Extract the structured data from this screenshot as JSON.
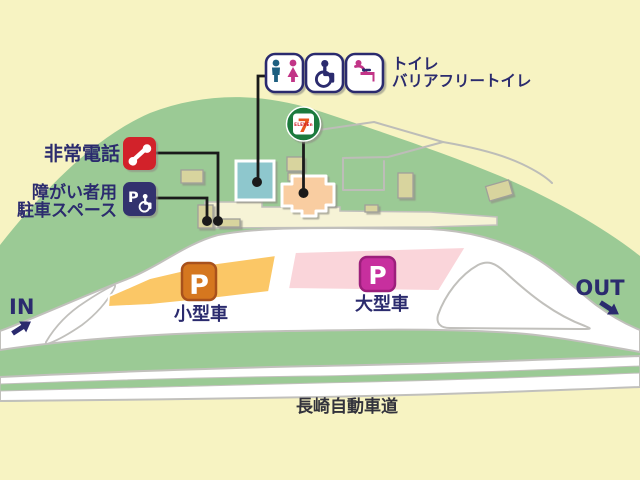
{
  "legend": {
    "toilet_line1": "トイレ",
    "toilet_line2": "バリアフリートイレ",
    "emergency_phone": "非常電話",
    "accessible_line1": "障がい者用",
    "accessible_line2": "駐車スペース"
  },
  "parking": {
    "small": {
      "badge": "P",
      "label": "小型車"
    },
    "large": {
      "badge": "P",
      "label": "大型車"
    }
  },
  "store": {
    "numeral": "7",
    "wordmark": "ELEVEn"
  },
  "road": {
    "in_label": "IN",
    "out_label": "OUT",
    "highway_name": "長崎自動車道"
  },
  "colors": {
    "background": "#f7f3c2",
    "hill": "#9bca95",
    "road": "#ffffff",
    "apron": "#f6f3d6",
    "parking_small": "#fbc766",
    "parking_large": "#fad5da",
    "badge_small": "#d5771f",
    "badge_large": "#c72f9e",
    "navy": "#2b2b6e",
    "phone_red": "#d2232a",
    "accessible_navy": "#32326e",
    "store_green": "#1a7a3e",
    "store_seven_orange": "#e8541d",
    "building_toilet": "#8ec7cd",
    "building_store": "#f9cda1",
    "building_misc": "#d8d49e"
  }
}
